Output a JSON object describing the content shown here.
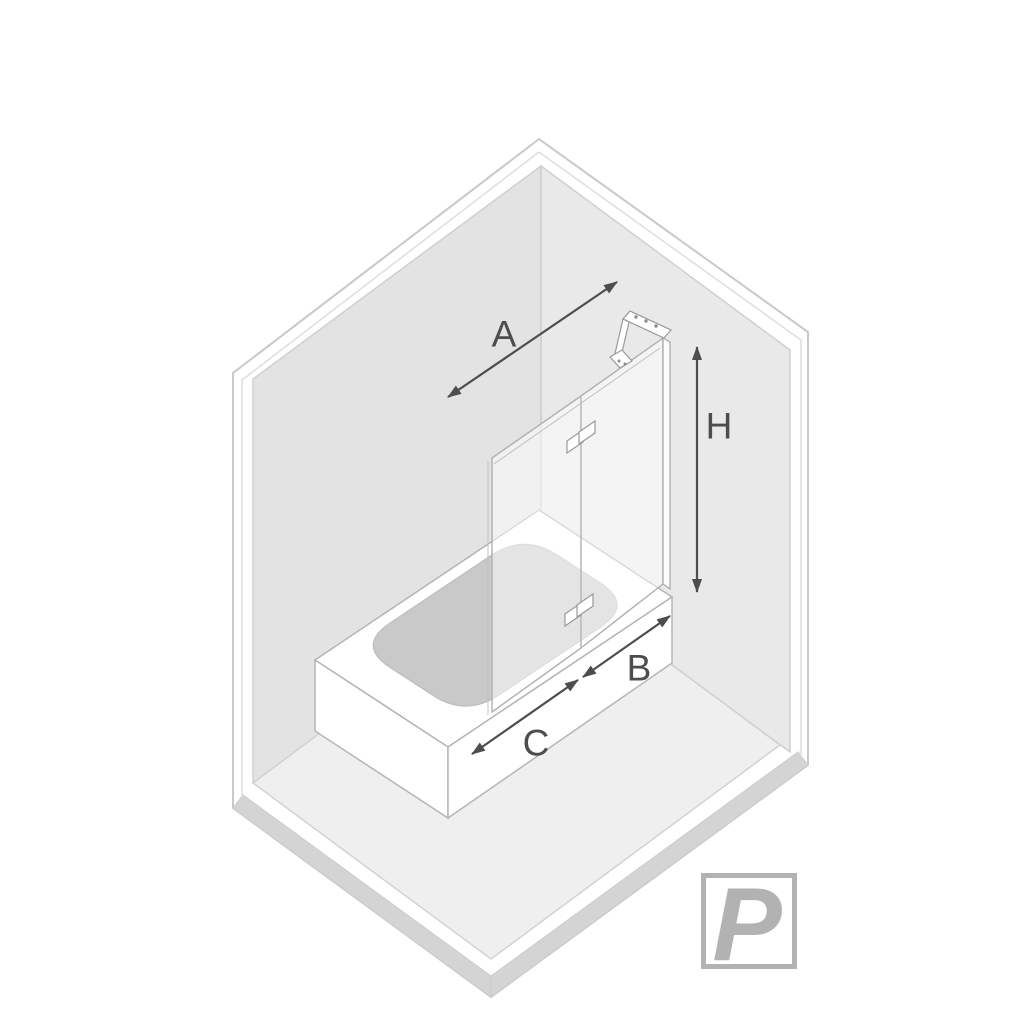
{
  "diagram": {
    "type": "isometric-bath-screen-dimension-drawing",
    "dimension_labels": {
      "screen_width": "A",
      "screen_height": "H",
      "tub_segment_right": "B",
      "tub_segment_left": "C"
    },
    "logo_letter": "P",
    "colors": {
      "background": "#ffffff",
      "left_wall": "#e3e3e3",
      "right_wall": "#e9e9e9",
      "floor": "#efefef",
      "edge_strip": "#d4d4d4",
      "tub": "#ffffff",
      "basin": "#c9c9c9",
      "dimension": "#4d4d4d",
      "logo": "#b2b2b2",
      "outline": "#c9c9c9"
    }
  }
}
